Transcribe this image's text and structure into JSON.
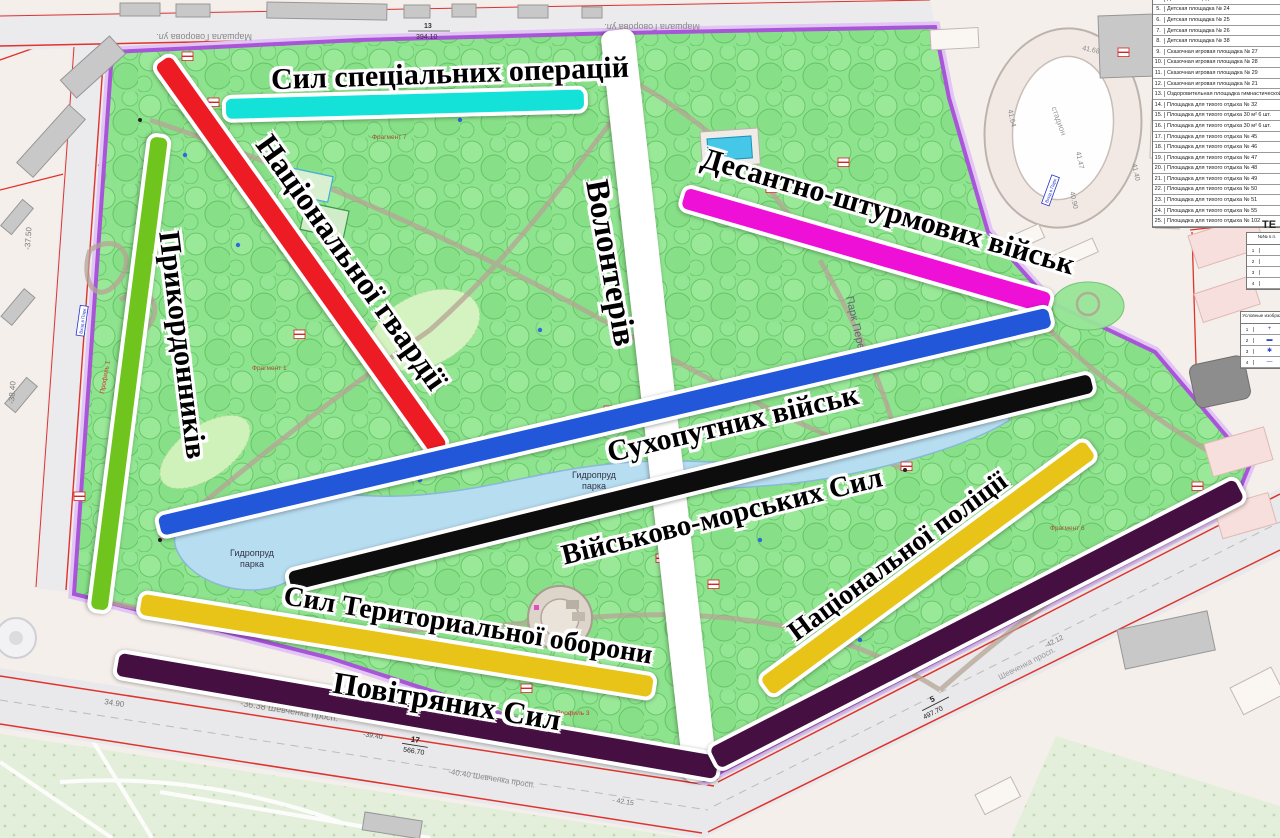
{
  "alleys": [
    {
      "id": "special-operations",
      "label": "Сил спеціальних операцій",
      "color": "#14e2d9"
    },
    {
      "id": "national-guard",
      "label": "Національної гвардії",
      "color": "#ed1c24"
    },
    {
      "id": "border-guards",
      "label": "Прикордонників",
      "color": "#6fc41d"
    },
    {
      "id": "volunteers",
      "label": "Волонтерів",
      "color": "#ffffff"
    },
    {
      "id": "air-assault",
      "label": "Десантно-штурмових військ",
      "color": "#ef10d8"
    },
    {
      "id": "ground-forces",
      "label": "Сухопутних військ",
      "color": "#2157d8"
    },
    {
      "id": "navy",
      "label": "Військово-морських Сил",
      "color": "#0d0d0d"
    },
    {
      "id": "national-police",
      "label": "Національної поліції",
      "color": "#e7c417"
    },
    {
      "id": "territorial-defense",
      "label": "Сил Териториальної оборони",
      "color": "#e7c417"
    },
    {
      "id": "air-force",
      "label": "Повітряних Сил",
      "color": "#451041"
    }
  ],
  "park": {
    "name_label": "Парк Перемоги",
    "lake_line1": "Гидропруд",
    "lake_line2": "парка",
    "fragment_7": "Фрагмент 7",
    "fragment_1": "Фрагмент 1",
    "fragment_6": "Фрагмент 6",
    "profile_3": "Профиль 3",
    "profile_1": "Профиль 1",
    "entrance_sign": "Вход в Парк"
  },
  "streets": {
    "top_street": "Маршала Говорова ул.",
    "m_top_num": "13",
    "m_top_val": "394.10",
    "label_36_38": "-36.38 Шевченка просп.",
    "label_40_40": "-40.40 Шевченка просп.",
    "label_shev": "Шевченка просп.",
    "m_bl_prefix": "-39.40",
    "m_bl_num": "17",
    "m_bl_val": "566.70",
    "m_br_num": "5",
    "m_br_val": "497.70",
    "elev_37": "-37.50",
    "elev_38": "-38.40",
    "elev_34": "34.90",
    "elev_42a": "- 42.15",
    "elev_42b": "-42.12"
  },
  "stadium": {
    "label": "стадион",
    "elev_a": "41.64",
    "elev_b": "41.47",
    "elev_c": "41.40",
    "elev_d": "40.90",
    "elev_e": "41.68"
  },
  "legend_table": {
    "rows": [
      {
        "num": "4.",
        "text": "Детская площадка № 23"
      },
      {
        "num": "5.",
        "text": "Детская площадка № 24"
      },
      {
        "num": "6.",
        "text": "Детская площадка № 25"
      },
      {
        "num": "7.",
        "text": "Детская площадка № 26"
      },
      {
        "num": "8.",
        "text": "Детская площадка № 38"
      },
      {
        "num": "9.",
        "text": "Сказочная игровая площадка № 27"
      },
      {
        "num": "10.",
        "text": "Сказочная игровая площадка № 28"
      },
      {
        "num": "11.",
        "text": "Сказочная игровая площадка № 29"
      },
      {
        "num": "12.",
        "text": "Сказочная игровая площадка № 21"
      },
      {
        "num": "13.",
        "text": "Оздоровительная площадка гимнастической п."
      },
      {
        "num": "14.",
        "text": "Площадка для тихого отдыха № 32"
      },
      {
        "num": "15.",
        "text": "Площадка для тихого отдыха 30 м² 6 шт."
      },
      {
        "num": "16.",
        "text": "Площадка для тихого отдыха 30 м² 6 шт."
      },
      {
        "num": "17.",
        "text": "Площадка для тихого отдыха № 45"
      },
      {
        "num": "18.",
        "text": "Площадка для тихого отдыха № 46"
      },
      {
        "num": "19.",
        "text": "Площадка для тихого отдыха № 47"
      },
      {
        "num": "20.",
        "text": "Площадка для тихого отдыха № 48"
      },
      {
        "num": "21.",
        "text": "Площадка для тихого отдыха № 49"
      },
      {
        "num": "22.",
        "text": "Площадка для тихого отдыха № 50"
      },
      {
        "num": "23.",
        "text": "Площадка для тихого отдыха № 51"
      },
      {
        "num": "24.",
        "text": "Площадка для тихого отдыха № 55"
      },
      {
        "num": "25.",
        "text": "Площадка для тихого отдыха № 102"
      }
    ]
  },
  "side_tables": {
    "te": "ТЕ",
    "t1_header": "№№ п.п.",
    "t1_rows": [
      {
        "n": "1"
      },
      {
        "n": "2"
      },
      {
        "n": "3"
      },
      {
        "n": "4"
      }
    ],
    "t2_header": "Условные изображ.",
    "t2_rows": [
      {
        "n": "1",
        "sym": "+"
      },
      {
        "n": "2",
        "sym": "▬"
      },
      {
        "n": "3",
        "sym": "✱"
      },
      {
        "n": "4",
        "sym": "—"
      }
    ]
  }
}
